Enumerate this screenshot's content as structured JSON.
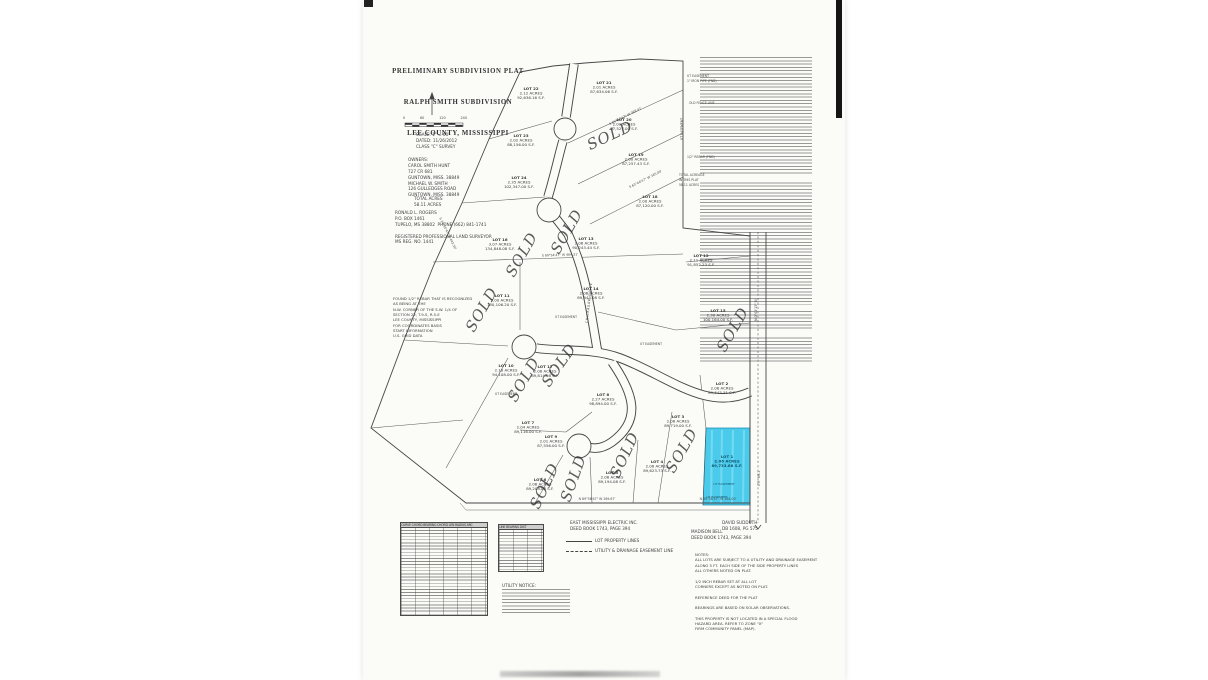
{
  "page": {
    "background": "#ffffff",
    "paper_color": "#fbfbf8",
    "ink_color": "#3f3f3f",
    "highlight_color": "#3cc7ea"
  },
  "title_block": {
    "line1": "PRELIMINARY SUBDIVISION PLAT",
    "line2": "RALPH SMITH SUBDIVISION",
    "line3": "LEE COUNTY, MISSISSIPPI"
  },
  "scale_bar": {
    "ticks": [
      "0",
      "60",
      "120",
      "240"
    ]
  },
  "scale_text": {
    "lines": [
      "SCALE: 1\" = 60'",
      "DATED: 11/26/2012",
      "CLASS \"C\" SURVEY"
    ]
  },
  "owners_block": {
    "lines": [
      "OWNERS:",
      "CAROL SMITH HUNT",
      "727 CR 681",
      "GUNTOWN, MISS. 38849",
      "MICHAEL W. SMITH",
      "126 GULLEDGES ROAD",
      "GUNTOWN, MISS. 38849"
    ]
  },
  "total_block": {
    "lines": [
      "TOTAL ACRES",
      "58.11 ACRES"
    ]
  },
  "surveyor_block": {
    "lines": [
      "RONALD L. ROGERS",
      "P.O. BOX 1461",
      "TUPELO, MS 38802  PHONE (662) 841-1741",
      "",
      "REGISTERED PROFESSIONAL LAND SURVEYOR",
      "MS REG. NO. 1441"
    ]
  },
  "benchmark_block": {
    "lines": [
      "FOUND 1/2\" REBAR THAT IS RECOGNIZED",
      "AS BEING AT THE",
      "N.W. CORNER OF THE S.W. 1/4 OF",
      "SECTION 22, T.9-S, R.5-E",
      "LEE COUNTY, MISSISSIPPI",
      "FOR COORDINATES BASIS",
      "START INFORMATION",
      "U.S. GRID DATA"
    ]
  },
  "map": {
    "lots": [
      {
        "n": "LOT 22",
        "a": "2.12 ACRES",
        "s": "92,636.16 S.F.",
        "x": 531,
        "y": 90
      },
      {
        "n": "LOT 21",
        "a": "2.01 ACRES",
        "s": "87,634.06 S.F.",
        "x": 604,
        "y": 84
      },
      {
        "n": "LOT 23",
        "a": "2.02 ACRES",
        "s": "88,156.00 S.F.",
        "x": 521,
        "y": 137
      },
      {
        "n": "LOT 20",
        "a": "2.01 ACRES",
        "s": "87,527.00 S.F.",
        "x": 624,
        "y": 121
      },
      {
        "n": "LOT 24",
        "a": "2.35 ACRES",
        "s": "102,347.00 S.F.",
        "x": 519,
        "y": 179
      },
      {
        "n": "LOT 19",
        "a": "2.00 ACRES",
        "s": "87,257.43 S.F.",
        "x": 636,
        "y": 156
      },
      {
        "n": "LOT 18",
        "a": "2.00 ACRES",
        "s": "87,120.00 S.F.",
        "x": 650,
        "y": 198
      },
      {
        "n": "LOT 16",
        "a": "3.07 ACRES",
        "s": "134,848.08 S.F.",
        "x": 500,
        "y": 241
      },
      {
        "n": "LOT 13",
        "a": "2.06 ACRES",
        "s": "90,243.44 S.F.",
        "x": 586,
        "y": 240
      },
      {
        "n": "LOT 12",
        "a": "2.11 ACRES",
        "s": "91,852.23 S.F.",
        "x": 701,
        "y": 257
      },
      {
        "n": "LOT 15",
        "a": "2.30 ACRES",
        "s": "100,164.00 S.F.",
        "x": 718,
        "y": 312
      },
      {
        "n": "LOT 14",
        "a": "2.06 ACRES",
        "s": "89,843.08 S.F.",
        "x": 591,
        "y": 290
      },
      {
        "n": "LOT 11",
        "a": "3.00 ACRES",
        "s": "130,106.20 S.F.",
        "x": 502,
        "y": 297
      },
      {
        "n": "LOT 17",
        "a": "2.06 ACRES",
        "s": "89,814.08 S.F.",
        "x": 545,
        "y": 368
      },
      {
        "n": "LOT 10",
        "a": "2.16 ACRES",
        "s": "94,108.00 S.F.",
        "x": 506,
        "y": 367
      },
      {
        "n": "LOT 2",
        "a": "2.06 ACRES",
        "s": "89,545.51 S.F.",
        "x": 722,
        "y": 385
      },
      {
        "n": "LOT 8",
        "a": "2.27 ACRES",
        "s": "98,894.00 S.F.",
        "x": 603,
        "y": 396
      },
      {
        "n": "LOT 7",
        "a": "2.04 ACRES",
        "s": "89,116.00 S.F.",
        "x": 528,
        "y": 424
      },
      {
        "n": "LOT 3",
        "a": "2.06 ACRES",
        "s": "89,719.00 S.F.",
        "x": 678,
        "y": 418
      },
      {
        "n": "LOT 9",
        "a": "2.01 ACRES",
        "s": "87,556.00 S.F.",
        "x": 551,
        "y": 438
      },
      {
        "n": "LOT 4",
        "a": "2.06 ACRES",
        "s": "89,623.73 S.F.",
        "x": 657,
        "y": 463
      },
      {
        "n": "LOT 5",
        "a": "2.06 ACRES",
        "s": "89,194.08 S.F.",
        "x": 612,
        "y": 474
      },
      {
        "n": "LOT 6",
        "a": "2.06 ACRES",
        "s": "89,208.08 S.F.",
        "x": 540,
        "y": 481
      }
    ],
    "highlight_lot": {
      "lines": [
        "LOT 1",
        "2.06 ACRES",
        "89,733.88 S.F."
      ],
      "x": 727,
      "y": 458,
      "easement_note": "UT EASEMENT",
      "color": "#3cc7ea",
      "label_color": "#10566e"
    },
    "sold_marks": [
      {
        "x": 612,
        "y": 140,
        "r": -25
      },
      {
        "x": 571,
        "y": 234,
        "r": -60
      },
      {
        "x": 526,
        "y": 257,
        "r": -60
      },
      {
        "x": 486,
        "y": 312,
        "r": -60
      },
      {
        "x": 563,
        "y": 368,
        "r": -55
      },
      {
        "x": 528,
        "y": 382,
        "r": -60
      },
      {
        "x": 549,
        "y": 488,
        "r": -65
      },
      {
        "x": 578,
        "y": 480,
        "r": -70
      },
      {
        "x": 629,
        "y": 457,
        "r": -65
      },
      {
        "x": 686,
        "y": 453,
        "r": -60
      },
      {
        "x": 737,
        "y": 332,
        "r": -60
      }
    ],
    "sold_text": "SOLD",
    "bearings": [
      {
        "t": "S 89°54'47\" W   464.21'",
        "x": 560,
        "y": 256,
        "r": -2
      },
      {
        "t": "S 65°27'47\" W   368.41'",
        "x": 626,
        "y": 117,
        "r": -27
      },
      {
        "t": "S 63°44'47\" W   345.00'",
        "x": 646,
        "y": 180,
        "r": -27
      },
      {
        "t": "S 24°10'47\" E   443.30'",
        "x": 447,
        "y": 234,
        "r": 64
      },
      {
        "t": "N 89°58'47\" W   269.67'",
        "x": 597,
        "y": 500,
        "r": 0
      },
      {
        "t": "N 89°58'47\" W   264.00'",
        "x": 718,
        "y": 500,
        "r": 0
      },
      {
        "t": "N 0°01'13\" W",
        "x": 757,
        "y": 310,
        "r": -90
      }
    ],
    "edge_labels": [
      {
        "t": "UT EASEMENT",
        "x": 687,
        "y": 77,
        "r": 0
      },
      {
        "t": "1\" IRON PIPE (FND)",
        "x": 687,
        "y": 82,
        "r": 0
      },
      {
        "t": "OLD FENCE LINE",
        "x": 689,
        "y": 104,
        "r": 0
      },
      {
        "t": "UT EASEMENT",
        "x": 683,
        "y": 140,
        "r": -90
      },
      {
        "t": "1/2\" REBAR (FND)",
        "x": 687,
        "y": 158,
        "r": 0
      },
      {
        "t": "TOTAL ACREAGE",
        "x": 679,
        "y": 176,
        "r": 0
      },
      {
        "t": "IN THIS PLAT",
        "x": 679,
        "y": 181,
        "r": 0
      },
      {
        "t": "58.11 ACRES",
        "x": 679,
        "y": 186,
        "r": 0
      },
      {
        "t": "UT EASEMENT",
        "x": 555,
        "y": 318,
        "r": 0
      },
      {
        "t": "UT EASEMENT",
        "x": 495,
        "y": 395,
        "r": 0
      },
      {
        "t": "UT EASEMENT",
        "x": 640,
        "y": 345,
        "r": 0
      }
    ],
    "road_labels": [
      {
        "t": "CHICKASAW DRIVE",
        "x": 590,
        "y": 303,
        "r": -84
      },
      {
        "t": "CR 681",
        "x": 760,
        "y": 478,
        "r": -90
      }
    ]
  },
  "curve_table": {
    "headers": "CURVE  CHORD BEARING  CHORD LEN  RADIUS  ARC"
  },
  "line_table": {
    "headers": "LINE  BEARING  DIST"
  },
  "utility_co": {
    "lines": [
      "EAST MISSISSIPPI ELECTRIC INC.",
      "DEED BOOK 1743, PAGE 394"
    ]
  },
  "legend": {
    "property_line_label": "LOT PROPERTY LINES",
    "easement_line_label": "UTILITY & DRAINAGE EASEMENT LINE"
  },
  "adjoiners": {
    "david": {
      "lines": [
        "DAVID SUDDUTH",
        "DB 1608, PG 575"
      ]
    },
    "madison": {
      "lines": [
        "MADISON BELL",
        "DEED BOOK 1743, PAGE 394"
      ]
    }
  },
  "notes_block": {
    "lines": [
      "NOTES:",
      "ALL LOTS ARE SUBJECT TO A UTILITY AND DRAINAGE EASEMENT",
      "ALONG 5 FT. EACH SIDE OF THE SIDE PROPERTY LINES",
      "ALL OTHERS NOTED ON PLAT.",
      "",
      "1/2 INCH REBAR SET AT ALL LOT",
      "CORNERS EXCEPT AS NOTED ON PLAT.",
      "",
      "REFERENCE DEED FOR THE PLAT",
      "",
      "BEARINGS ARE BASED ON SOLAR OBSERVATIONS.",
      "",
      "THIS PROPERTY IS NOT LOCATED IN A SPECIAL FLOOD",
      "HAZARD AREA. REFER TO ZONE \"X\"",
      "FIRM COMMUNITY PANEL (MAP)."
    ]
  },
  "utility_notice": {
    "title": "UTILITY NOTICE:"
  }
}
